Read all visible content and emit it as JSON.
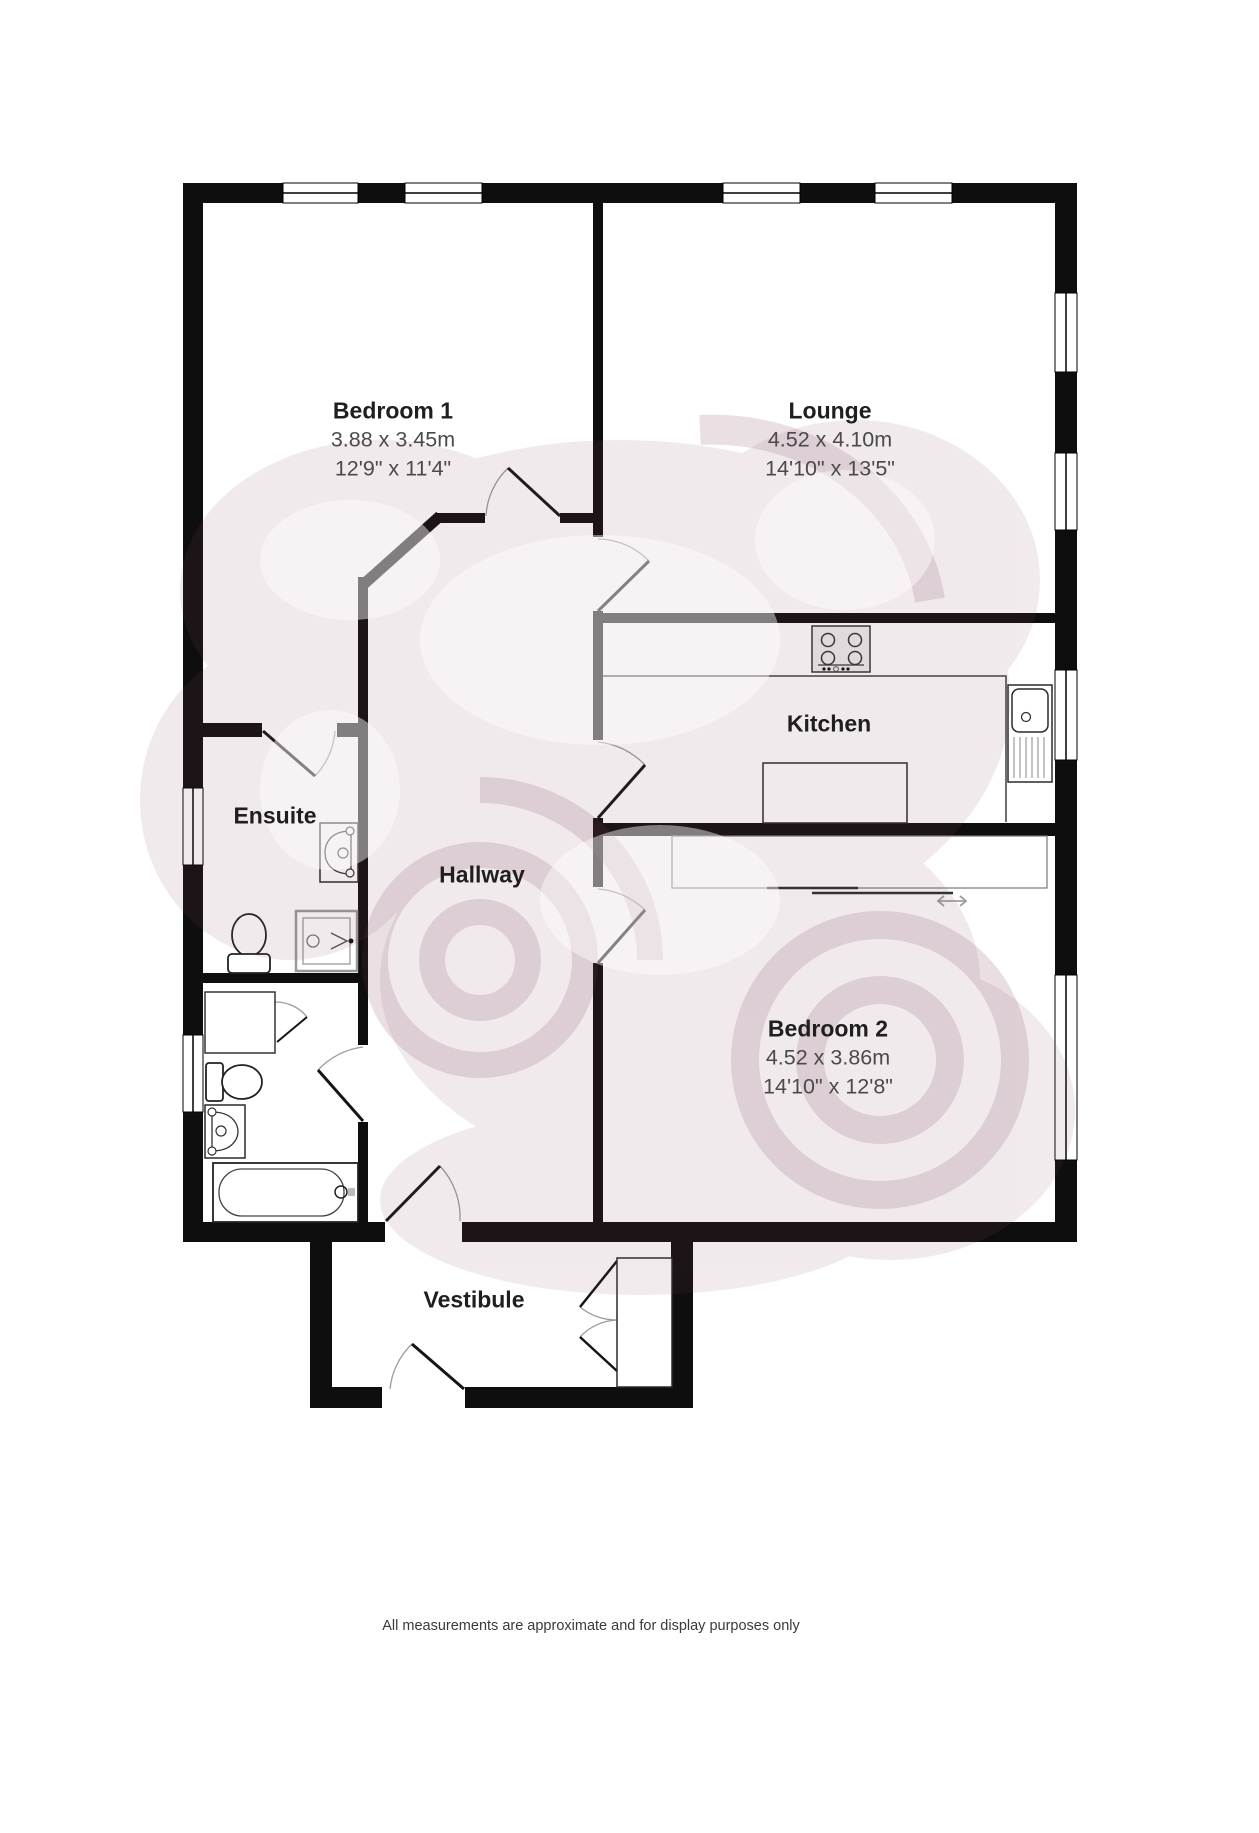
{
  "rooms": [
    {
      "name": "Bedroom 1",
      "metric": "3.88 x 3.45m",
      "imperial": "12'9\" x 11'4\""
    },
    {
      "name": "Lounge",
      "metric": "4.52 x 4.10m",
      "imperial": "14'10\" x 13'5\""
    },
    {
      "name": "Kitchen"
    },
    {
      "name": "Ensuite"
    },
    {
      "name": "Hallway"
    },
    {
      "name": "Bedroom 2",
      "metric": "4.52 x 3.86m",
      "imperial": "14'10\" x 12'8\""
    },
    {
      "name": "Vestibule"
    }
  ],
  "footer": "All measurements are approximate and for display purposes only",
  "colors": {
    "wall": "#0e0e0e",
    "room_fill": "#ffffff",
    "door_arc": "#9b9b9b",
    "watermark": "#8a4a63",
    "title_text": "#1f1f1f",
    "dimension_text": "#4a4a4a"
  },
  "icons": {
    "window": "white rect with centre glazing line",
    "door-swing-icon": "leaf line + quarter arc",
    "hob-icon": "square with 4 burner circles and control dots",
    "kitchen-sink-icon": "basin with drain circle and drainer lines",
    "basin-icon": "D-shaped bowl with taps and drain",
    "shower-icon": "double-bordered square with drain and spray arrow",
    "toilet-icon": "cistern rectangle with bowl",
    "bath-icon": "rounded tub with tap",
    "wardrobe-icon": "sliding-door unit",
    "closet-icon": "double-door cupboard",
    "sliding-arrow-icon": "⟷"
  }
}
